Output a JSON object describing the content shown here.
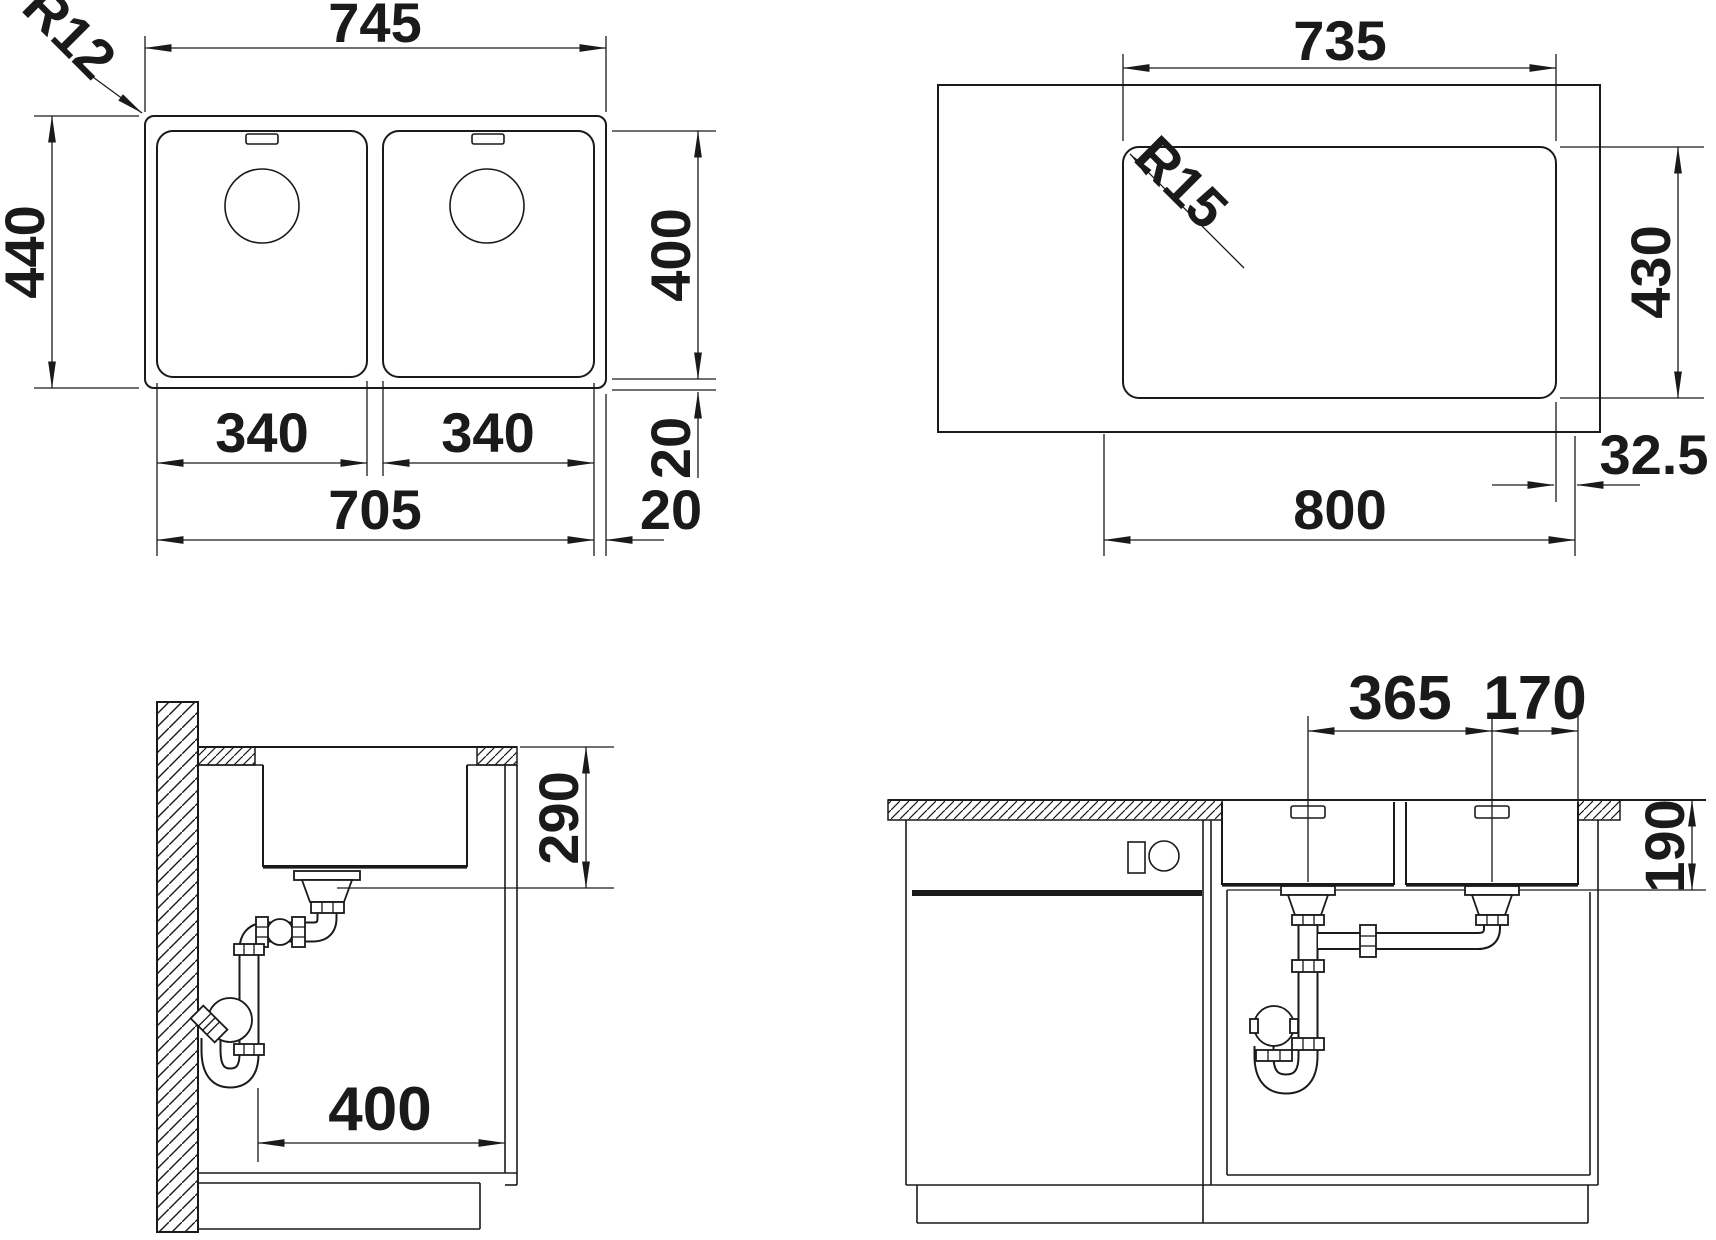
{
  "drawing": {
    "top_plan": {
      "width": "745",
      "depth": "440",
      "corner_radius": "R12",
      "bowl_left_width": "340",
      "bowl_right_width": "340",
      "bowls_span": "705",
      "rim_side": "20",
      "rim_back": "20",
      "bowl_inner_depth": "400"
    },
    "cutout_plan": {
      "cutout_width": "735",
      "corner_radius": "R15",
      "cutout_depth": "430",
      "edge_offset": "32.5",
      "cabinet_width": "800"
    },
    "side_section": {
      "clearance_height": "290",
      "clearance_width": "400"
    },
    "front_section": {
      "drain_spacing": "365",
      "drain_to_edge": "170",
      "bowl_depth": "190"
    }
  },
  "colors": {
    "line": "#1a1a1a",
    "background": "#ffffff"
  }
}
